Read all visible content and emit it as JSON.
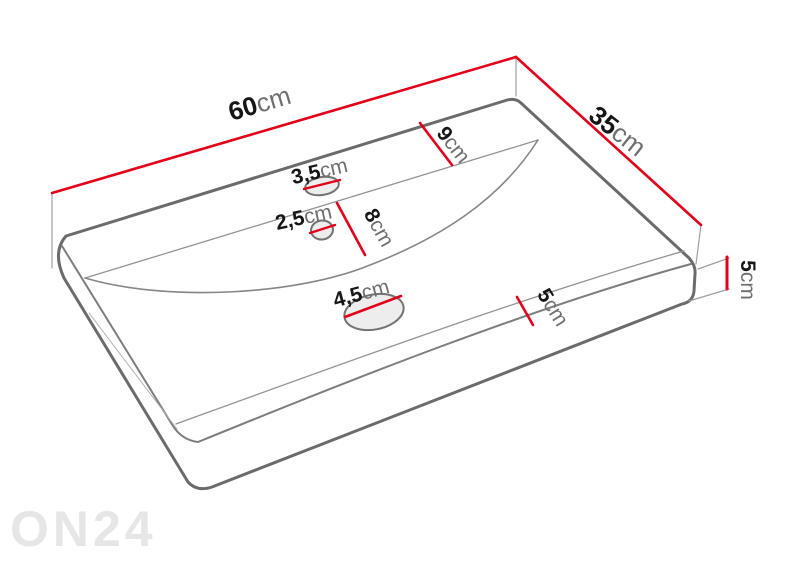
{
  "diagram": {
    "type": "technical-dimension-drawing",
    "subject": "washbasin-perspective-view",
    "colors": {
      "dimension_accent": "#e2001a",
      "outline_gray": "#6b6b6b",
      "watermark_gray": "#e6e6e6",
      "label_value": "#161616",
      "label_unit": "#6f6f6f"
    },
    "dims": {
      "width": {
        "value": "60",
        "unit": "cm"
      },
      "depth": {
        "value": "35",
        "unit": "cm"
      },
      "back_deck": {
        "value": "9",
        "unit": "cm"
      },
      "basin_span": {
        "value": "8",
        "unit": "cm"
      },
      "faucet_hole": {
        "value": "3,5",
        "unit": "cm"
      },
      "secondary_hole": {
        "value": "2,5",
        "unit": "cm"
      },
      "drain_hole": {
        "value": "4,5",
        "unit": "cm"
      },
      "edge_height": {
        "value": "5",
        "unit": "cm"
      },
      "front_deck": {
        "value": "5",
        "unit": "cm"
      }
    },
    "watermark": "ON24"
  }
}
